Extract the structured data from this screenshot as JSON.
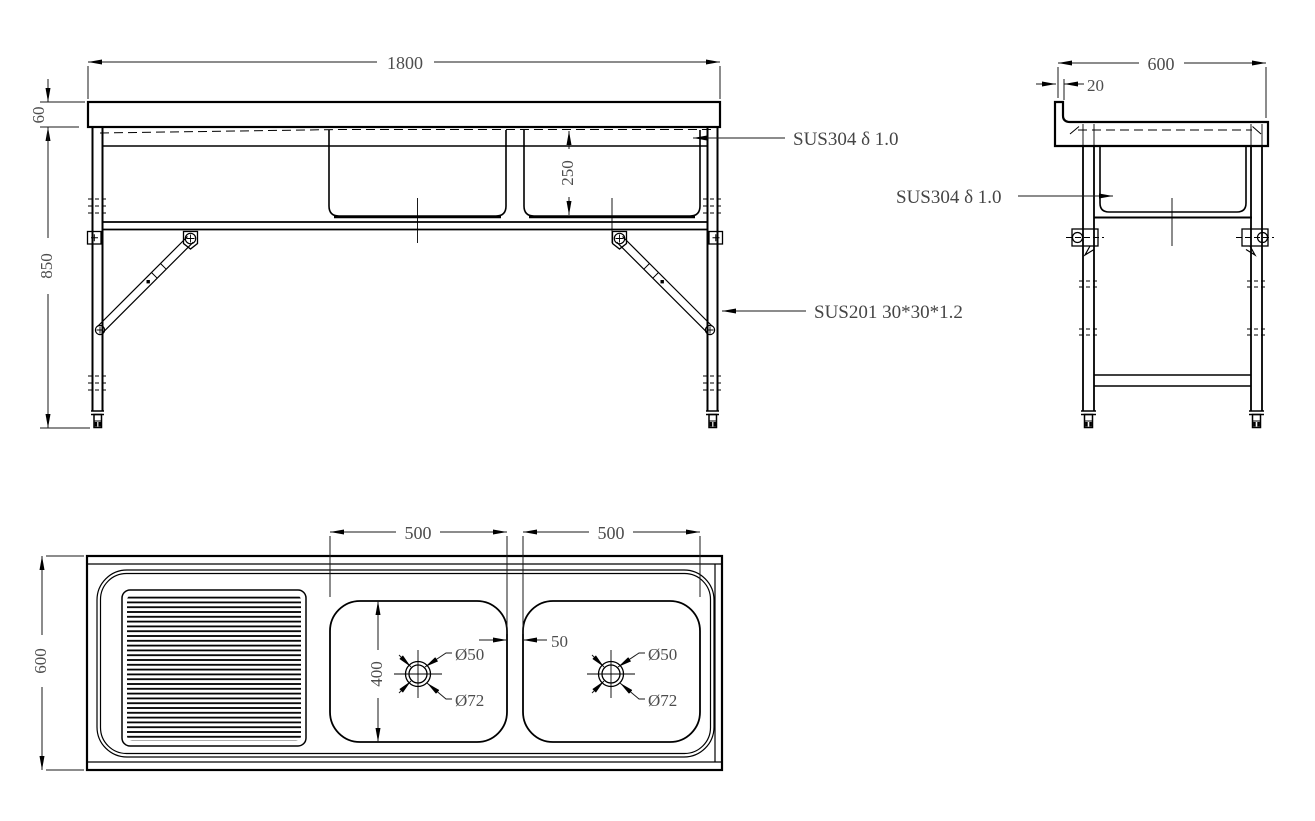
{
  "drawing": {
    "type": "technical-drawing",
    "subject": "double-bowl stainless steel sink bench, three orthographic views",
    "colors": {
      "line": "#000000",
      "dim_text": "#4d4d4d",
      "background": "#ffffff"
    },
    "front_view": {
      "dim_overall_width": "1800",
      "dim_top_thickness": "60",
      "dim_overall_height": "850",
      "dim_bowl_depth": "250",
      "label_top_material": "SUS304 δ 1.0",
      "label_frame_material": "SUS201 30*30*1.2"
    },
    "side_view": {
      "dim_overall_depth": "600",
      "dim_backsplash_thickness": "20",
      "label_bowl_material": "SUS304 δ 1.0"
    },
    "plan_view": {
      "dim_overall_depth": "600",
      "dim_bowl1_width": "500",
      "dim_bowl2_width": "500",
      "dim_bowl_gap": "50",
      "dim_bowl_length": "400",
      "label_drain_hole": "Ø50",
      "label_drain_flange": "Ø72"
    }
  }
}
